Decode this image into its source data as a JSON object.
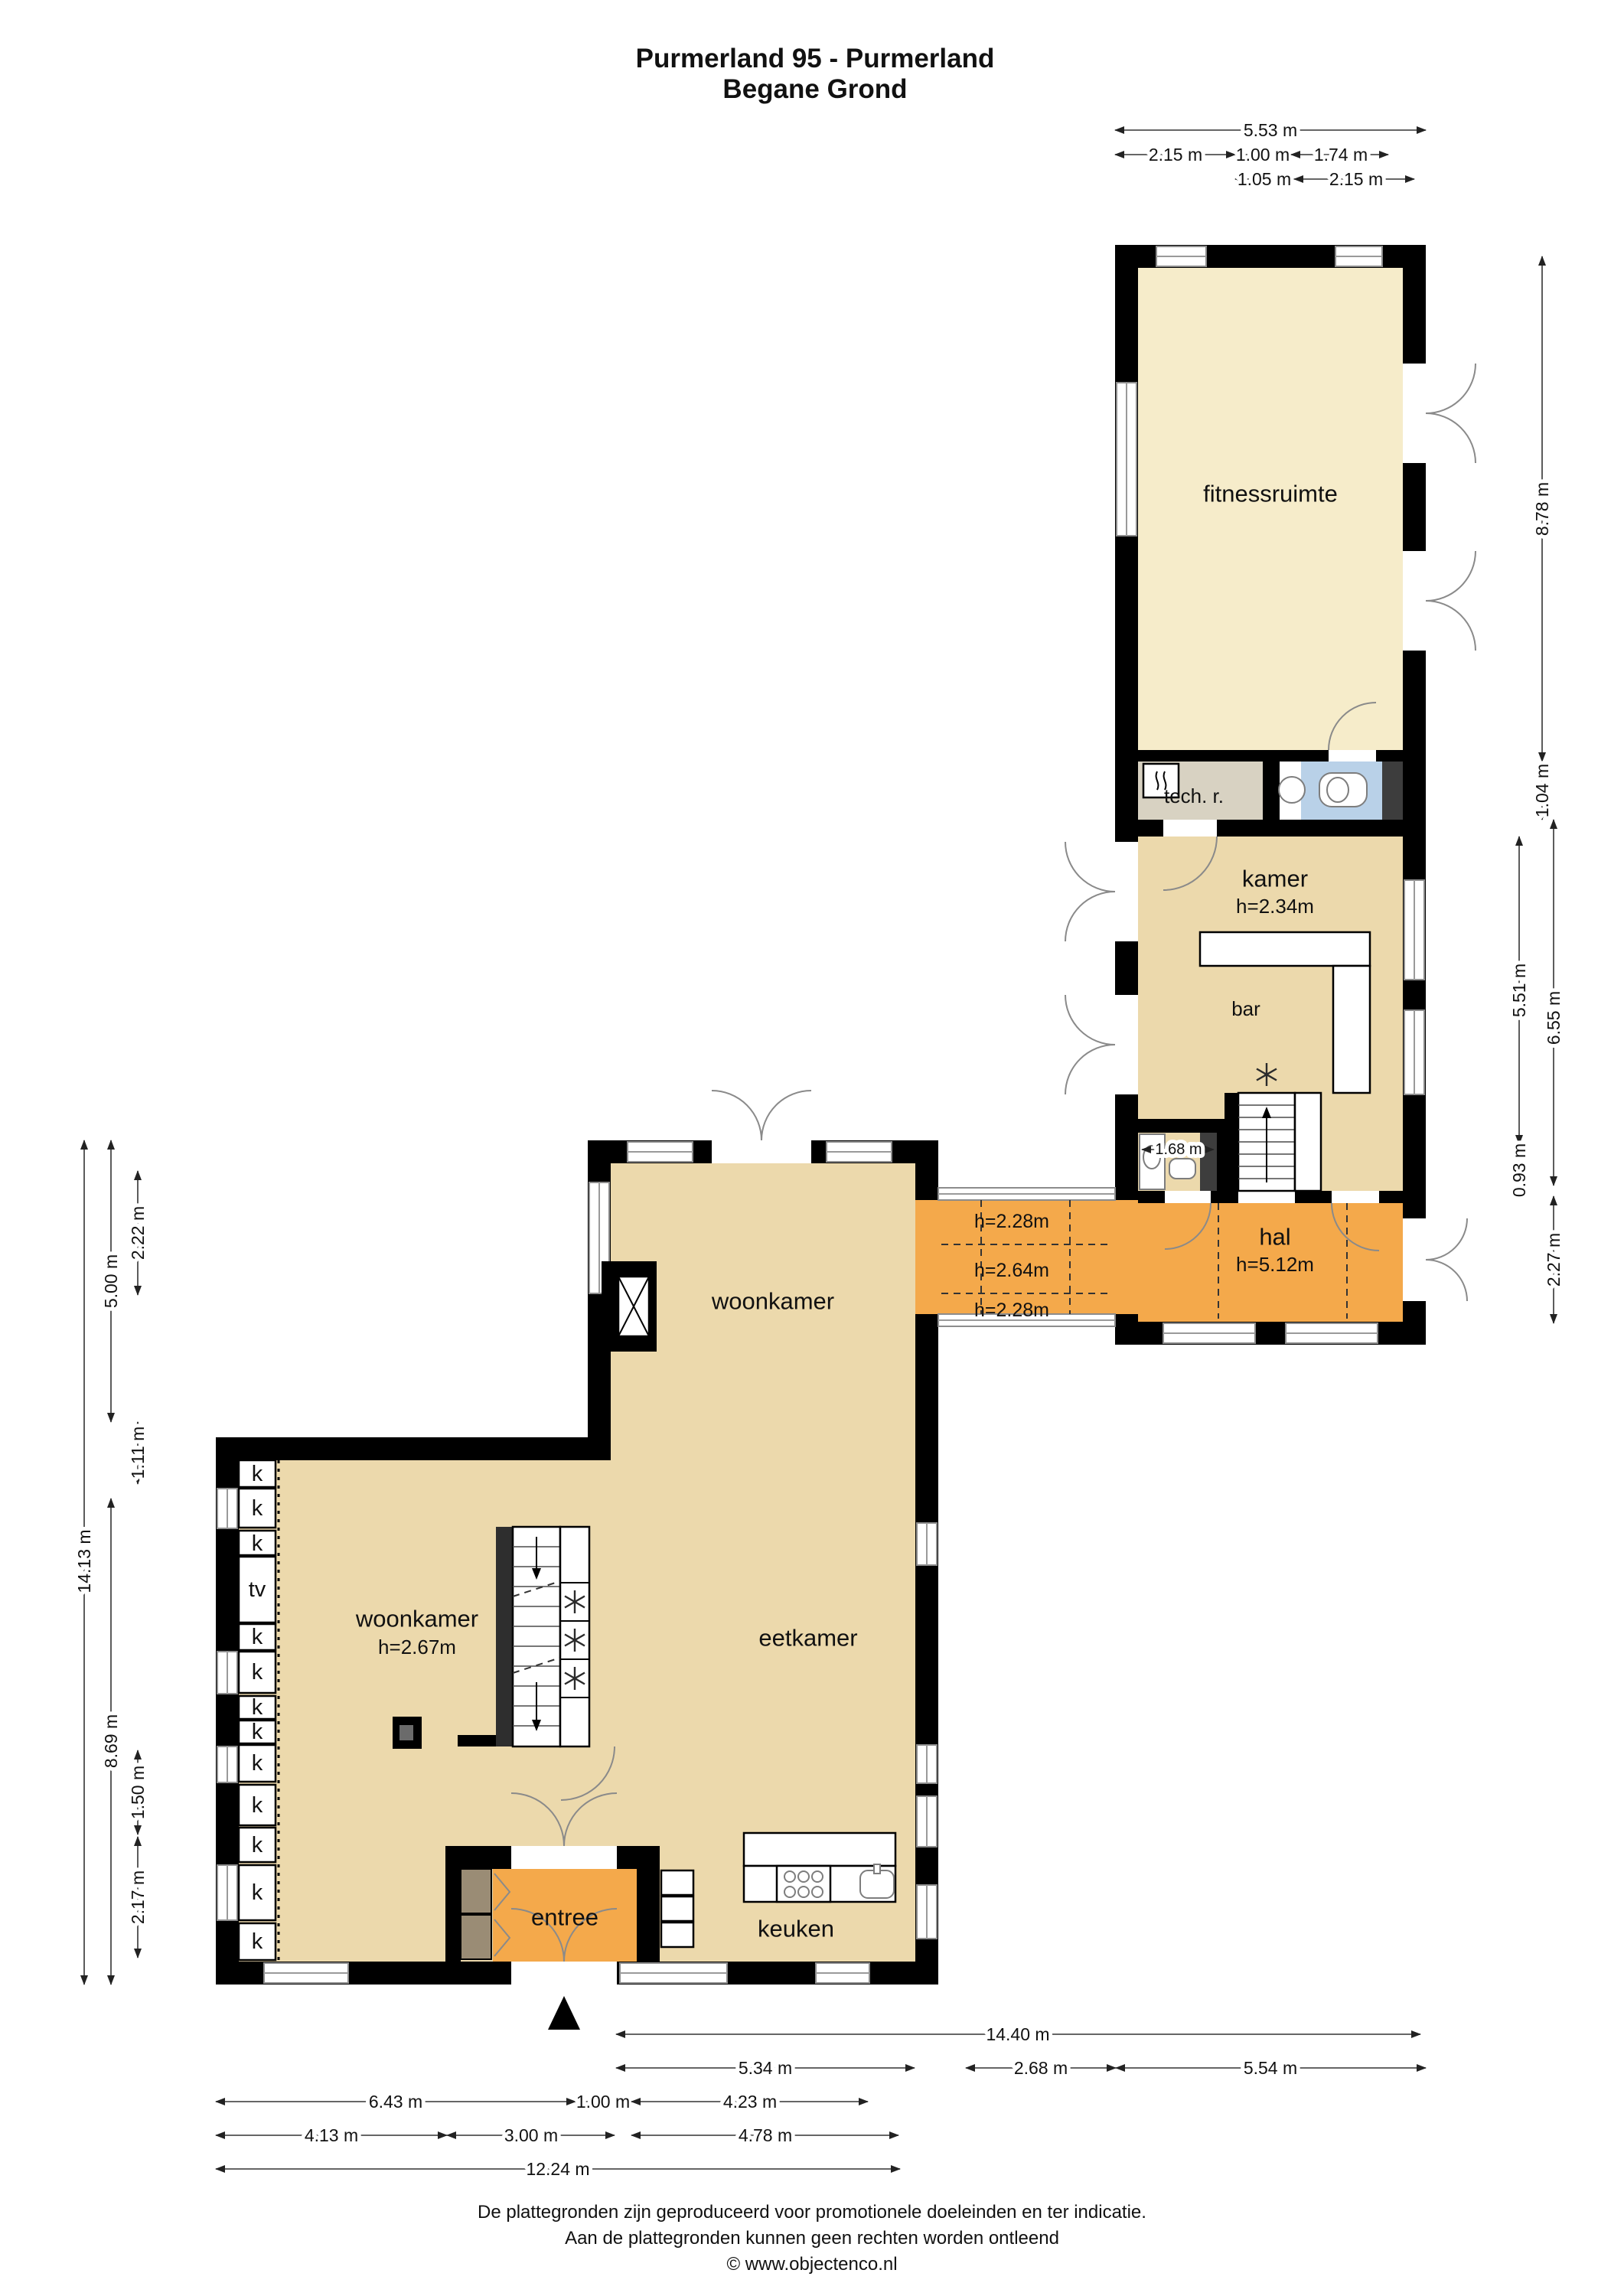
{
  "title": {
    "line1": "Purmerland 95 - Purmerland",
    "line2": "Begane Grond"
  },
  "rooms": {
    "fitnessruimte": "fitnessruimte",
    "tech": "tech. r.",
    "kamer": "kamer",
    "kamer_height": "h=2.34m",
    "bar": "bar",
    "hal": "hal",
    "hal_height": "h=5.12m",
    "woonkamer_upper": "woonkamer",
    "woonkamer": "woonkamer",
    "woonkamer_height": "h=2.67m",
    "eetkamer": "eetkamer",
    "entree": "entree",
    "keuken": "keuken"
  },
  "corridor": {
    "zone_top": "h=2.28m",
    "zone_middle": "h=2.64m",
    "zone_bottom": "h=2.28m"
  },
  "closets": {
    "closet": "k",
    "tv": "tv"
  },
  "dims": {
    "w_total": "5.53 m",
    "w_a": "2.15 m",
    "w_b": "1.00 m",
    "w_c": "1.74 m",
    "w_d": "1.05 m",
    "w_e": "2.15 m",
    "e_fitness": "8.78 m",
    "e_band": "1.04 m",
    "e_kamer_in": "5.51 m",
    "e_kamer_out": "6.55 m",
    "e_step": "0.93 m",
    "e_hal": "2.27 m",
    "l_total": "14.13 m",
    "l_upper": "5.00 m",
    "l_window": "2.22 m",
    "l_offset": "1.11 m",
    "l_lower": "8.69 m",
    "l_win2": "1.50 m",
    "l_corner": "2.17 m",
    "b_total_right": "14.40 m",
    "b_seg1": "5.34 m",
    "b_seg2": "2.68 m",
    "b_seg3": "5.54 m",
    "b_seg4": "6.43 m",
    "b_seg5": "1.00 m",
    "b_seg6": "4.23 m",
    "b_seg7": "4.13 m",
    "b_seg8": "3.00 m",
    "b_seg9": "4.78 m",
    "b_total_left": "12.24 m",
    "bath_width": "1.68 m"
  },
  "footer": {
    "line1": "De plattegronden zijn geproduceerd voor promotionele doeleinden en ter indicatie.",
    "line2": "Aan de plattegronden kunnen geen rechten worden ontleend",
    "line3": "© www.objectenco.nl"
  },
  "colors": {
    "floor_cream": "#f6ecca",
    "floor_tan": "#ecd9ac",
    "accent_orange": "#f4a94b",
    "room_gray": "#d8d2c2",
    "bath_blue": "#b9d1e8",
    "wall": "#000000"
  }
}
